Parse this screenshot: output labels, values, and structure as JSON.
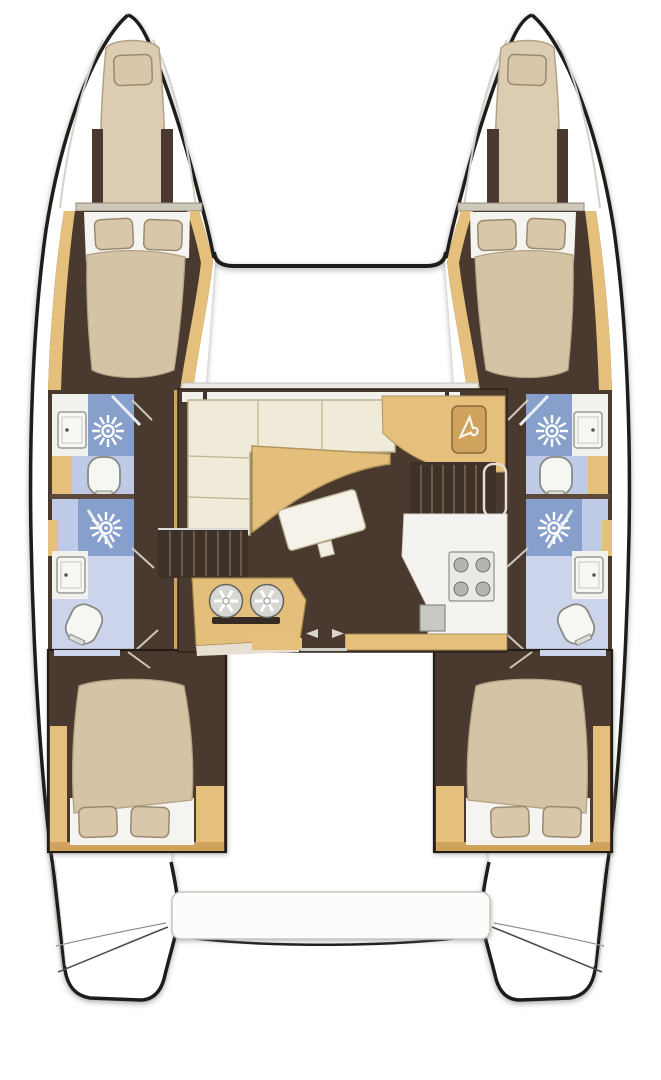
{
  "meta": {
    "title": "Catamaran interior layout floor plan",
    "view": "top-down",
    "vessel_type": "catamaran",
    "cabins": 4,
    "heads": 4
  },
  "colors": {
    "c-outline": "#1f1d1a",
    "c-tan": "#e5c07c",
    "c-tan-dark": "#cfa35e",
    "c-floor": "#4a392e",
    "c-steps": "#3e3127",
    "c-tread": "#6e5c4b",
    "c-bed": "#d5c3a6",
    "c-bed-line": "#b3a184",
    "c-pillow": "#d8c7ab",
    "c-pillow-line": "#9a8a6e",
    "c-sheet": "#f5f4f0",
    "c-sofa": "#f0ead9",
    "c-sofa-line": "#bfb28d",
    "c-table": "#e4bf7b",
    "c-shower-blue": "#87a0cb",
    "c-bath-blue": "#bfcae7",
    "c-bath-pale": "#ccd4ec",
    "c-fixture": "#f6f6f3",
    "c-deck": "#ffffff"
  },
  "port_hull": {
    "rooms": [
      {
        "name": "forepeak-berth",
        "furniture": [
          "single-berth",
          "pillow"
        ]
      },
      {
        "name": "forward-cabin",
        "furniture": [
          "double-bed",
          "pillow",
          "pillow"
        ]
      },
      {
        "name": "forward-head",
        "fixtures": [
          "shower",
          "sink",
          "toilet"
        ]
      },
      {
        "name": "aft-head",
        "fixtures": [
          "shower",
          "sink",
          "toilet"
        ]
      },
      {
        "name": "aft-cabin",
        "furniture": [
          "double-bed",
          "pillow",
          "pillow",
          "wardrobe"
        ]
      }
    ]
  },
  "starboard_hull": {
    "rooms": [
      {
        "name": "forepeak-berth",
        "furniture": [
          "single-berth",
          "pillow"
        ]
      },
      {
        "name": "forward-cabin",
        "furniture": [
          "double-bed",
          "pillow",
          "pillow"
        ]
      },
      {
        "name": "forward-head",
        "fixtures": [
          "shower",
          "sink",
          "toilet"
        ]
      },
      {
        "name": "aft-head",
        "fixtures": [
          "shower",
          "sink",
          "toilet"
        ]
      },
      {
        "name": "aft-cabin",
        "furniture": [
          "double-bed",
          "pillow",
          "pillow",
          "wardrobe"
        ]
      }
    ]
  },
  "salon": {
    "furniture": [
      "l-shaped-sofa",
      "curved-salon-table",
      "rotated-coffee-table",
      "small-stool",
      "nav-station",
      "wardrobe-locker-hanger-icon",
      "stairs-to-port-hull",
      "stairs-to-starboard-hull",
      "galley-sink-console-two-basins",
      "galley-counter",
      "stove-4-burner",
      "appliance-square",
      "sliding-door-arrows"
    ]
  },
  "deck": {
    "features": [
      "bow-trampoline-area",
      "front-crossbeam",
      "side-decks",
      "cockpit",
      "aft-bench-seat",
      "transom-steps-port",
      "transom-steps-starboard"
    ]
  }
}
